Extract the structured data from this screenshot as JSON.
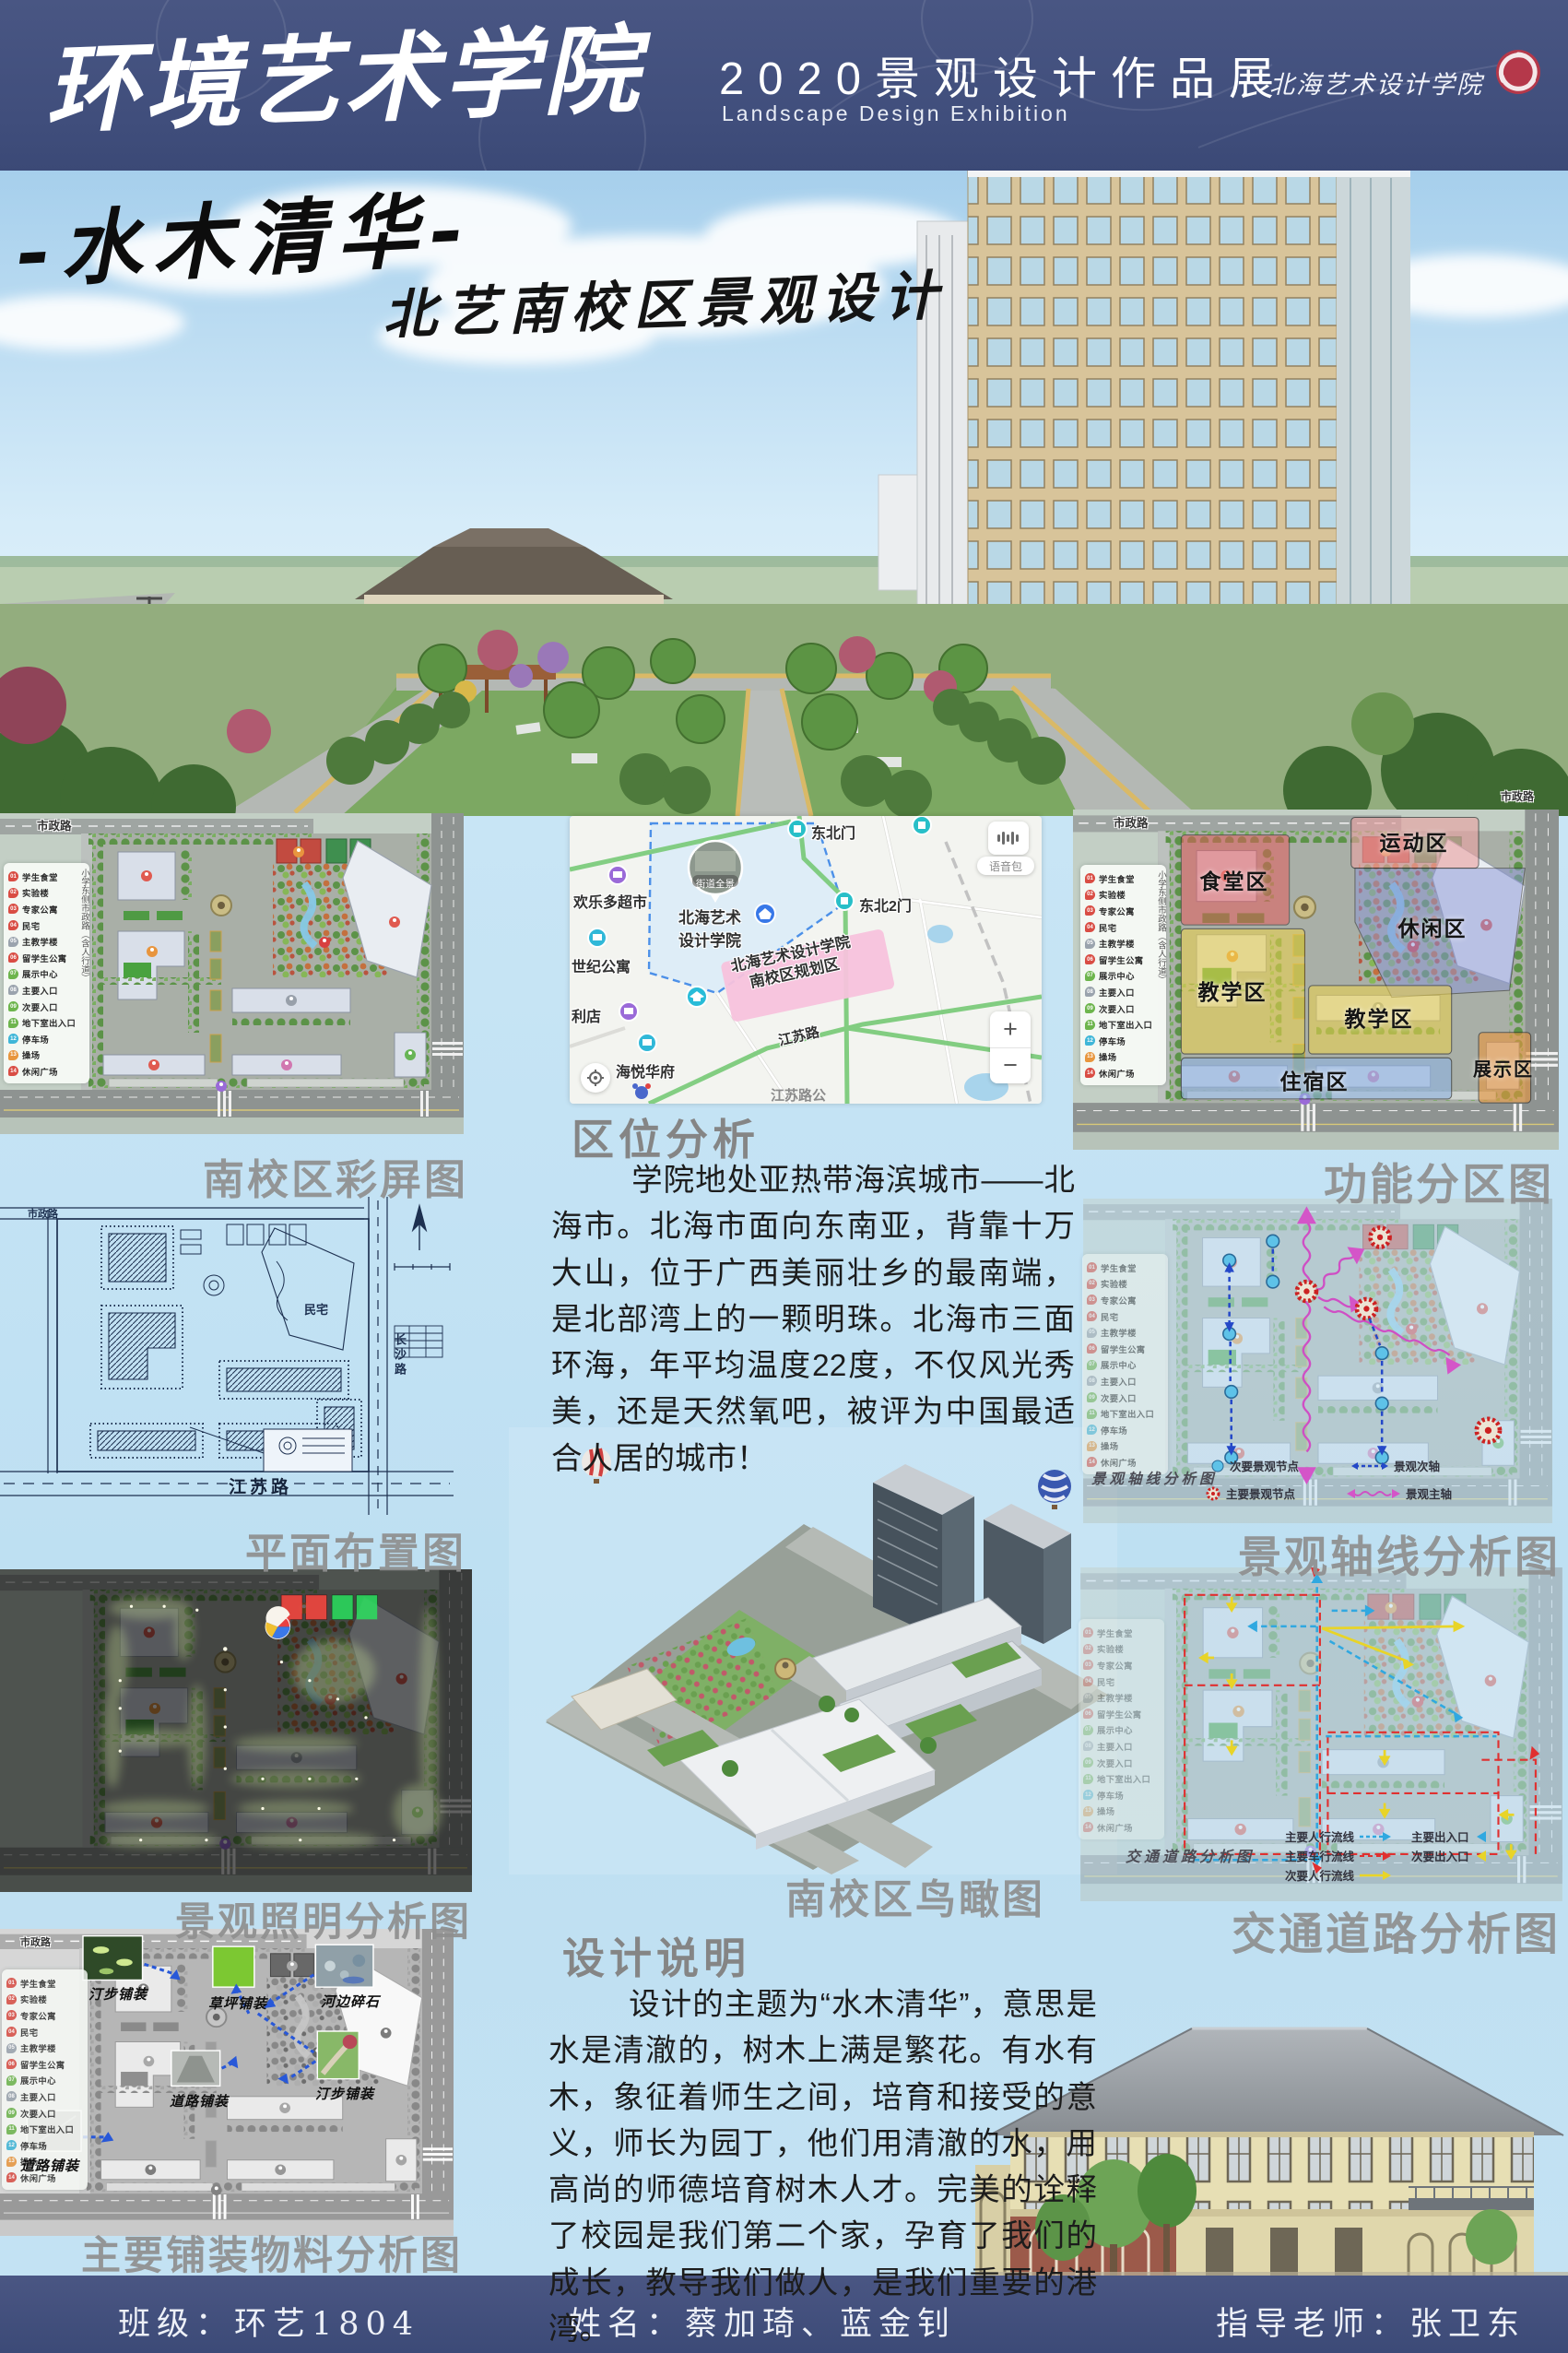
{
  "header": {
    "school": "环境艺术学院",
    "title": "2020景观设计作品展",
    "subtitle": "Landscape Design Exhibition",
    "logo": "北海艺术设计学院"
  },
  "hero": {
    "title": "-水木清华-",
    "subtitle": "北艺南校区景观设计"
  },
  "legend": {
    "items": [
      {
        "num": "01",
        "label": "学生食堂"
      },
      {
        "num": "02",
        "label": "实验楼"
      },
      {
        "num": "03",
        "label": "专家公寓"
      },
      {
        "num": "04",
        "label": "民宅"
      },
      {
        "num": "05",
        "label": "主教学楼"
      },
      {
        "num": "06",
        "label": "留学生公寓"
      },
      {
        "num": "07",
        "label": "展示中心"
      },
      {
        "num": "08",
        "label": "主要入口"
      },
      {
        "num": "09",
        "label": "次要入口"
      },
      {
        "num": "11",
        "label": "地下室出入口"
      },
      {
        "num": "12",
        "label": "停车场"
      },
      {
        "num": "13",
        "label": "操场"
      },
      {
        "num": "14",
        "label": "休闲广场"
      }
    ]
  },
  "roads": {
    "top": "市政路",
    "left": "小学东侧市政路（含人行道）",
    "bottom": "江苏路",
    "right": "长沙路"
  },
  "captions": {
    "color_plan": "南校区彩屏图",
    "layout_plan": "平面布置图",
    "lighting": "景观照明分析图",
    "paving": "主要铺装物料分析图",
    "birdseye": "南校区鸟瞰图",
    "zoning": "功能分区图",
    "axis": "景观轴线分析图",
    "traffic": "交通道路分析图"
  },
  "location": {
    "heading": "区位分析",
    "text": "学院地处亚热带海滨城市——北海市。北海市面向东南亚，背靠十万大山，位于广西美丽壮乡的最南端，是北部湾上的一颗明珠。北海市三面环海，年平均温度22度，不仅风光秀美，还是天然氧吧，被评为中国最适合人居的城市！"
  },
  "design": {
    "heading": "设计说明",
    "text": "设计的主题为“水木清华”，意思是水是清澈的，树木上满是繁花。有水有木，象征着师生之间，培育和接受的意义，师长为园丁，他们用清澈的水，用高尚的师德培育树木人才。完美的诠释了校园是我们第二个家，孕育了我们的成长，教导我们做人，是我们重要的港湾。"
  },
  "map": {
    "gate_ne": "东北门",
    "gate_ne2": "东北2门",
    "supermarket": "欢乐多超市",
    "apartment": "世纪公寓",
    "store": "利店",
    "residence": "海悦华府",
    "college_line1": "北海艺术",
    "college_line2": "设计学院",
    "area_line1": "北海艺术设计学院",
    "area_line2": "南校区规划区",
    "road": "江苏路",
    "bus_stop": "江苏路公",
    "photo": "街道全景",
    "voice": "语音包",
    "zoom_in": "+",
    "zoom_out": "−"
  },
  "blueprint": {
    "residence": "民宅"
  },
  "zones": {
    "canteen": "食堂区",
    "sports": "运动区",
    "leisure": "休闲区",
    "teaching_a": "教学区",
    "teaching_b": "教学区",
    "dorm": "住宿区",
    "exhibition": "展示区"
  },
  "axis": {
    "inner_caption": "景观轴线分析图",
    "legend": {
      "minor_node": "次要景观节点",
      "major_node": "主要景观节点",
      "minor_axis": "景观次轴",
      "major_axis": "景观主轴"
    }
  },
  "traffic": {
    "inner_caption": "交通道路分析图",
    "legend": {
      "main_ped": "主要人行流线",
      "main_car": "主要车行流线",
      "minor_ped": "次要人行流线",
      "main_entry": "主要出入口",
      "minor_entry": "次要出入口"
    }
  },
  "paving": {
    "stepping_a": "汀步铺装",
    "lawn": "草坪铺装",
    "stone": "河边碎石",
    "road_a": "道路铺装",
    "stepping_b": "汀步铺装",
    "road_b": "道路铺装"
  },
  "footer": {
    "class": "班级：环艺1804",
    "names": "姓名：蔡加琦、蓝金钊",
    "teacher": "指导老师：张卫东"
  }
}
